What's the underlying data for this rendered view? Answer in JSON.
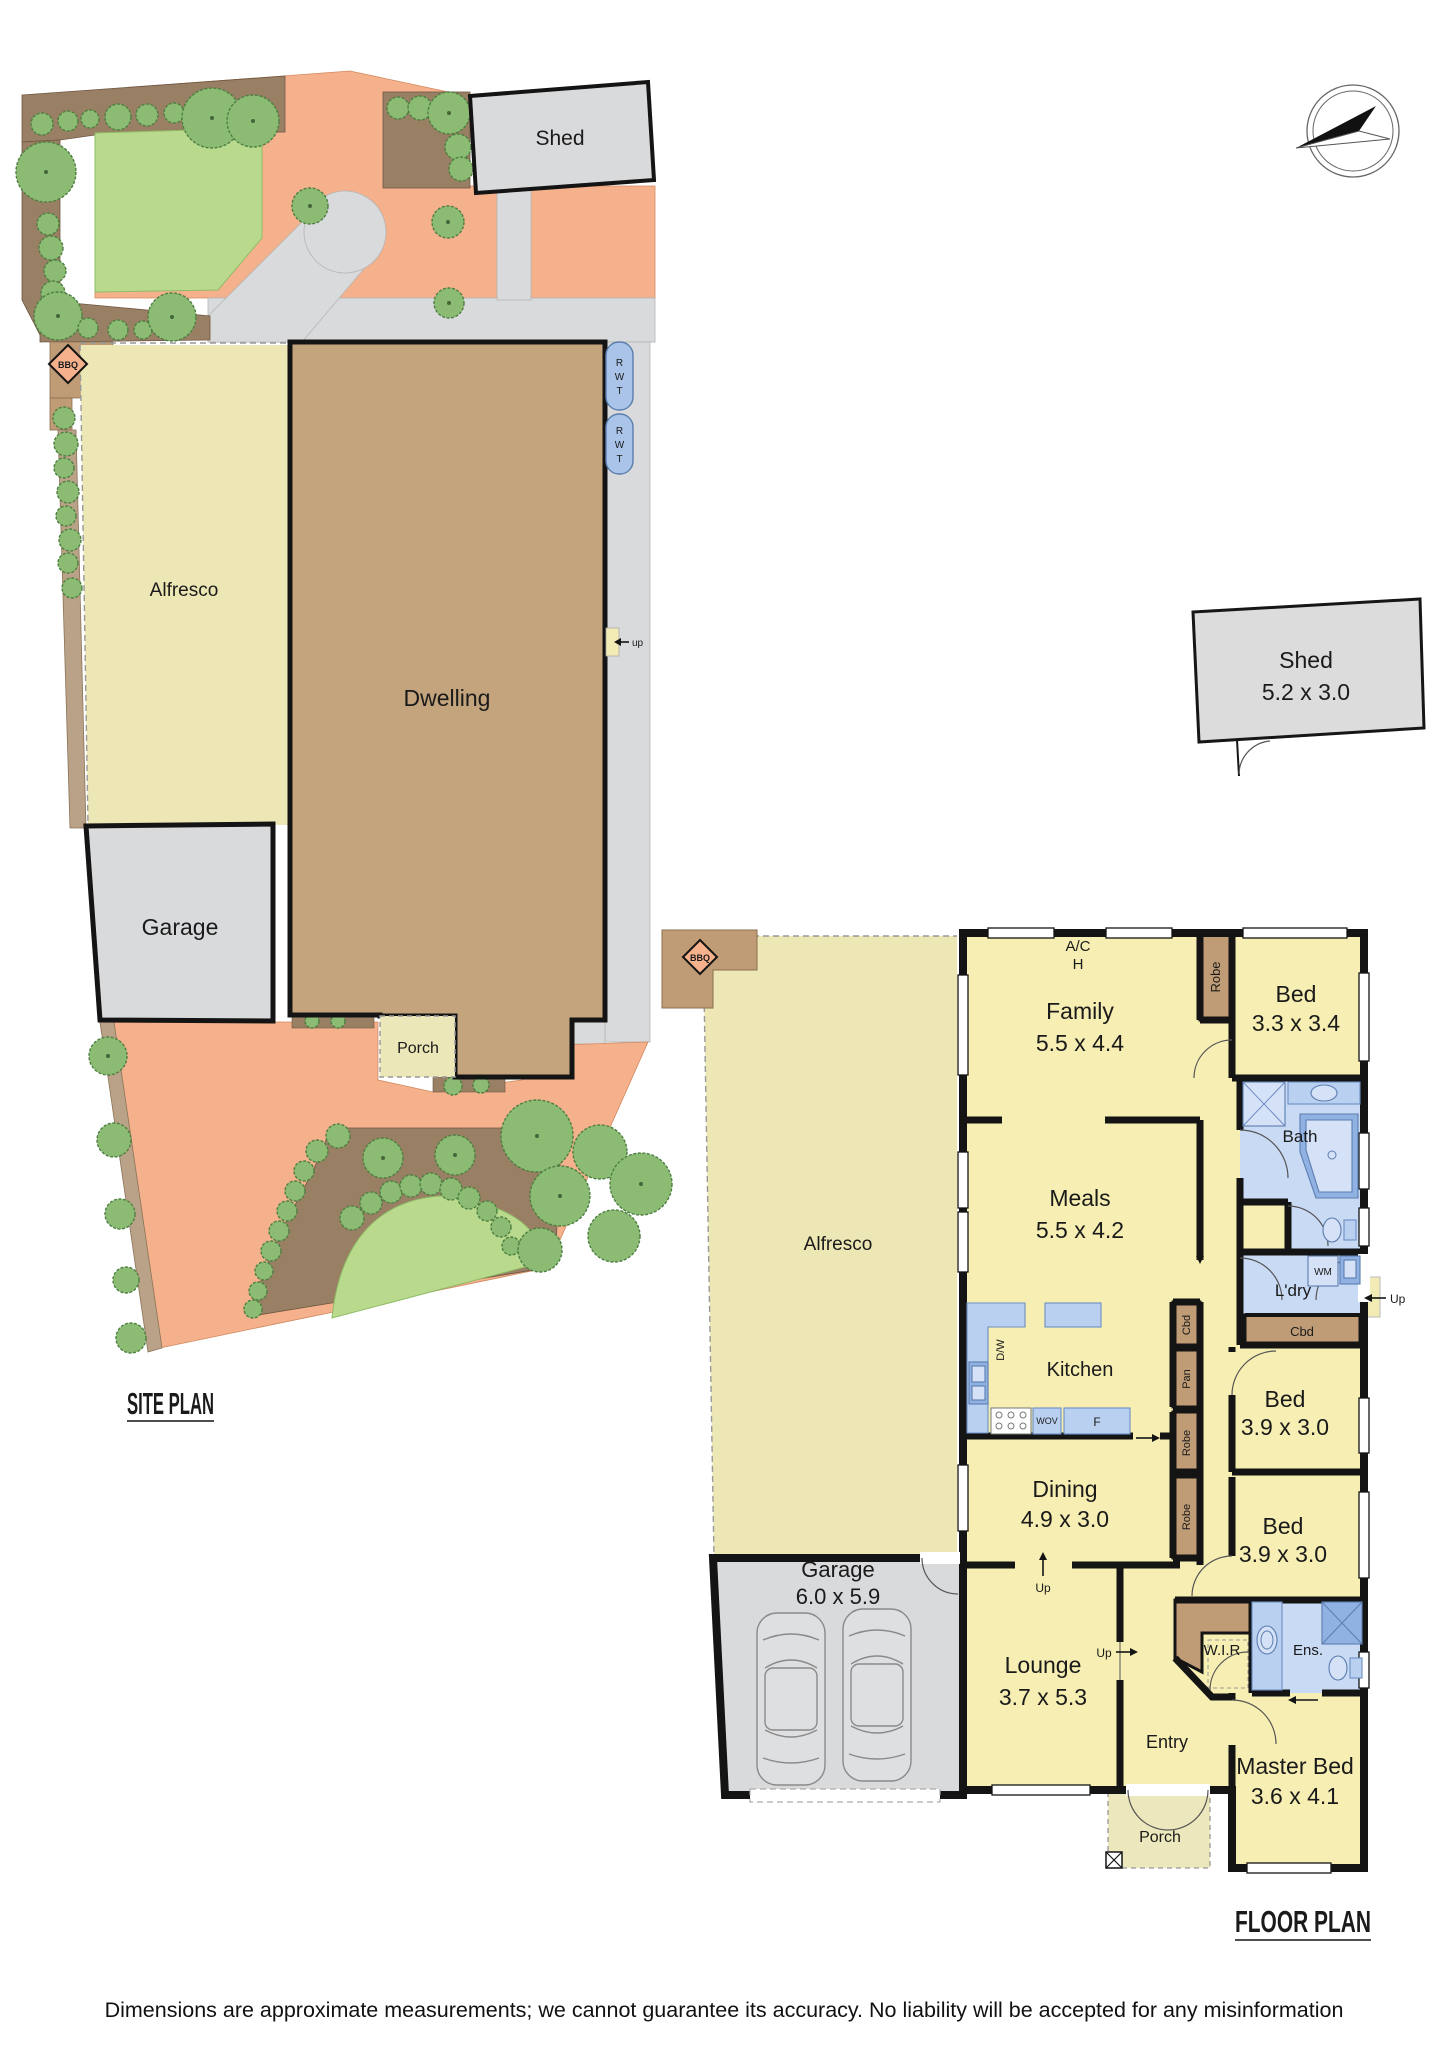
{
  "site_plan": {
    "title": "SITE PLAN",
    "shed_label": "Shed",
    "dwelling_label": "Dwelling",
    "alfresco_label": "Alfresco",
    "garage_label": "Garage",
    "porch_label": "Porch",
    "bbq_label": "BBQ",
    "up_label": "up",
    "rwt_letters": [
      "R",
      "W",
      "T"
    ]
  },
  "detached_shed": {
    "name": "Shed",
    "size": "5.2 x 3.0"
  },
  "floor_plan": {
    "title": "FLOOR PLAN",
    "alfresco_label": "Alfresco",
    "bbq_label": "BBQ",
    "ac_label_line1": "A/C",
    "ac_label_line2": "H",
    "robe_label": "Robe",
    "cbd_label": "Cbd",
    "pan_label": "Pan",
    "dw_label": "D/W",
    "wov_label": "WOV",
    "fridge_label": "F",
    "wm_label": "WM",
    "up_label": "Up",
    "kitchen_label": "Kitchen",
    "bath_label": "Bath",
    "ldry_label": "L'dry",
    "wir_label": "W.I.R",
    "ens_label": "Ens.",
    "entry_label": "Entry",
    "porch_label": "Porch",
    "rooms": {
      "family": {
        "name": "Family",
        "size": "5.5 x 4.4"
      },
      "bed_top": {
        "name": "Bed",
        "size": "3.3 x 3.4"
      },
      "meals": {
        "name": "Meals",
        "size": "5.5 x 4.2"
      },
      "bed_mid": {
        "name": "Bed",
        "size": "3.9 x 3.0"
      },
      "bed_low": {
        "name": "Bed",
        "size": "3.9 x 3.0"
      },
      "dining": {
        "name": "Dining",
        "size": "4.9 x 3.0"
      },
      "lounge": {
        "name": "Lounge",
        "size": "3.7 x 5.3"
      },
      "master": {
        "name": "Master Bed",
        "size": "3.6 x 4.1"
      },
      "garage": {
        "name": "Garage",
        "size": "6.0 x 5.9"
      }
    }
  },
  "footer": {
    "disclaimer": "Dimensions are approximate measurements; we cannot guarantee its accuracy. No liability will be accepted for any misinformation"
  }
}
